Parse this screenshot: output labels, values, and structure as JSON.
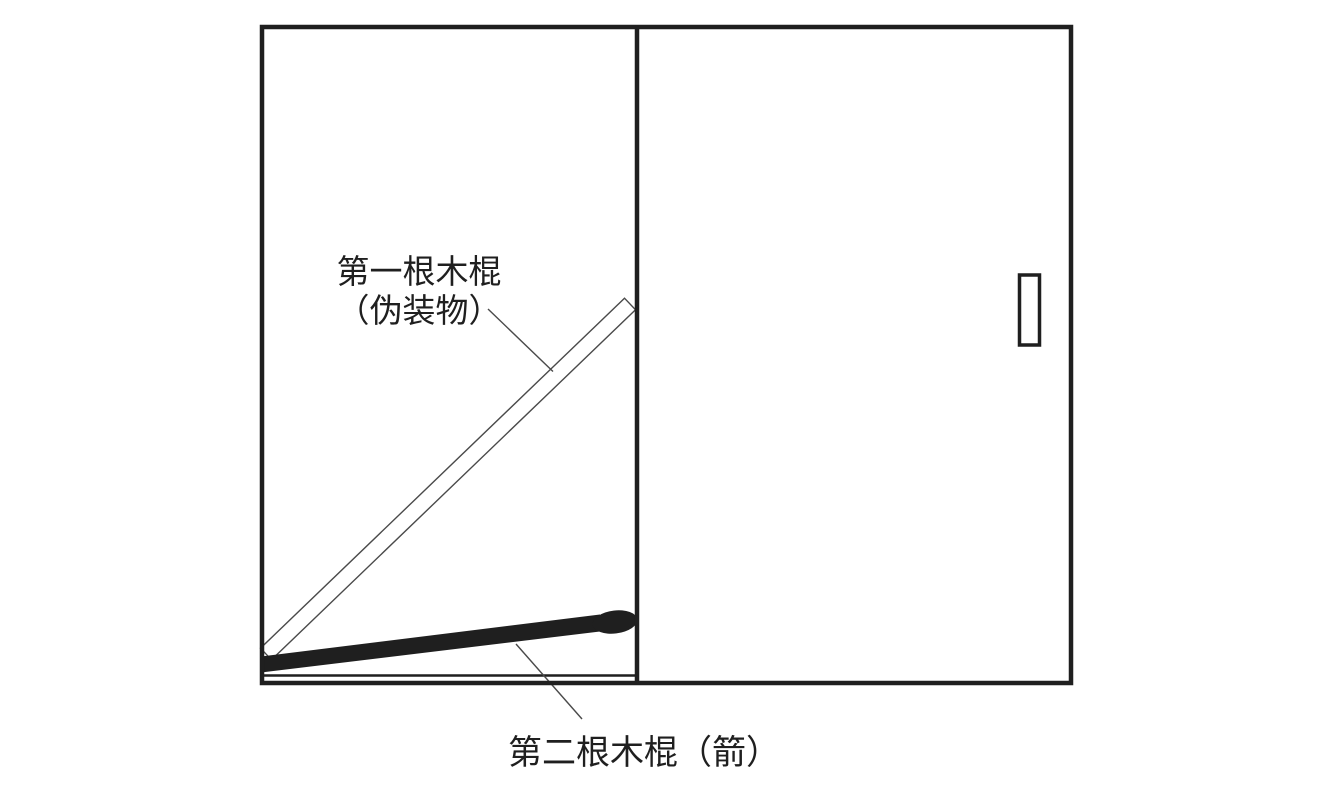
{
  "colors": {
    "ink": "#1f1f1f",
    "line": "#4a4a4a",
    "background": "#ffffff"
  },
  "diagram": {
    "labels": {
      "first_stick_line1": "第一根木棍",
      "first_stick_line2": "（伪装物）",
      "second_stick": "第二根木棍（箭）"
    }
  }
}
